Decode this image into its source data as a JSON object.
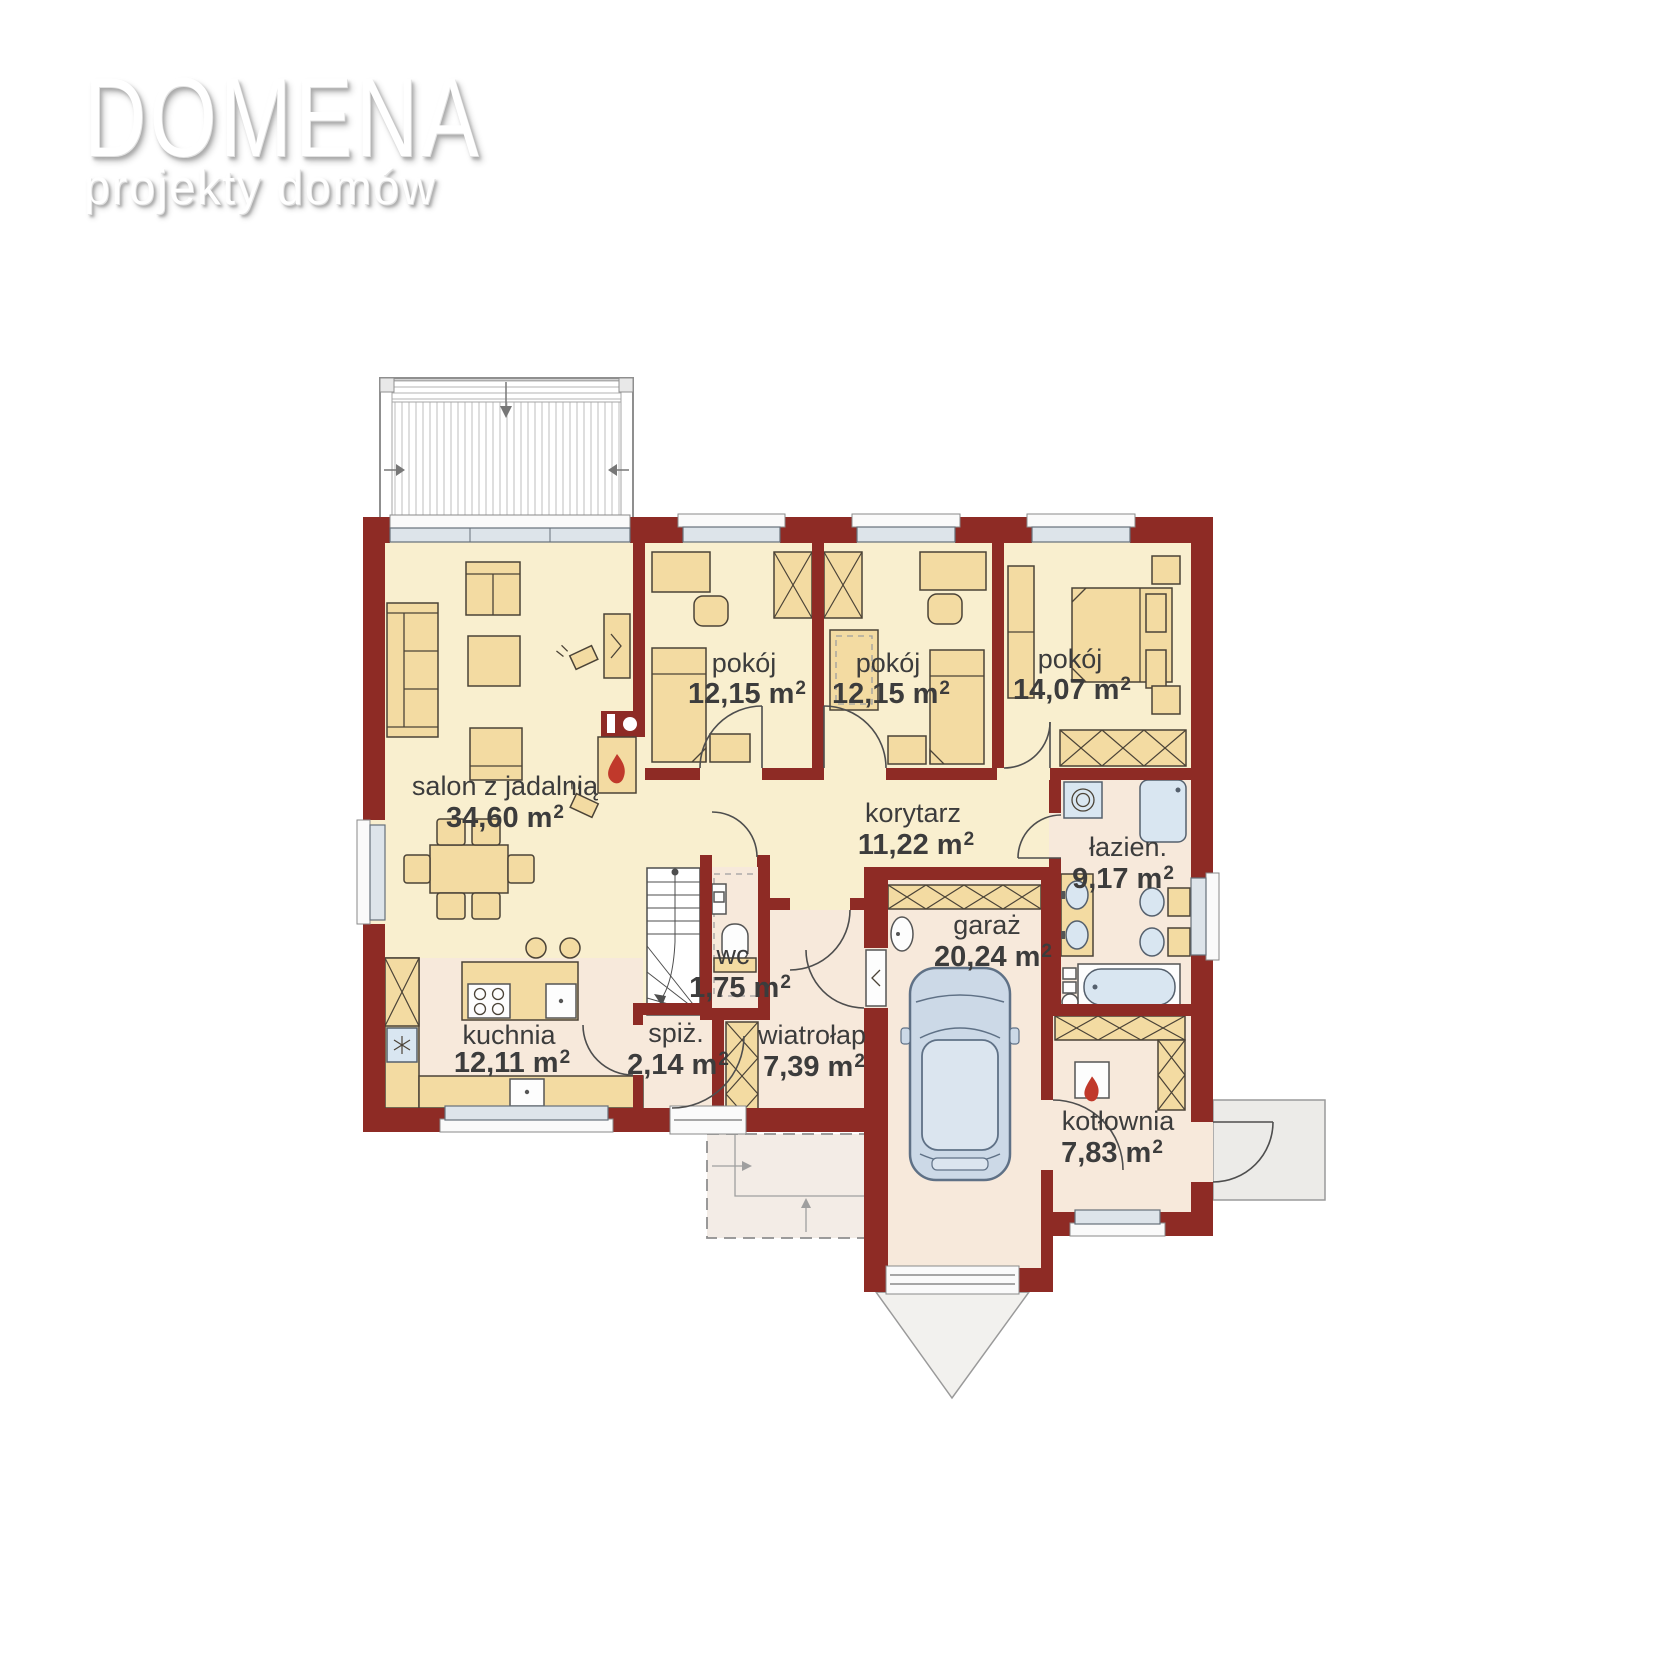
{
  "logo": {
    "title": "DOMENA",
    "subtitle": "projekty domów"
  },
  "units": {
    "m": "m",
    "sup": "2"
  },
  "rooms": {
    "salon": {
      "name": "salon z jadalnią",
      "area": "34,60"
    },
    "pokoj1": {
      "name": "pokój",
      "area": "12,15"
    },
    "pokoj2": {
      "name": "pokój",
      "area": "12,15"
    },
    "pokoj3": {
      "name": "pokój",
      "area": "14,07"
    },
    "korytarz": {
      "name": "korytarz",
      "area": "11,22"
    },
    "lazienka": {
      "name": "łazien.",
      "area": "9,17"
    },
    "wc": {
      "name": "wc",
      "area": "1,75"
    },
    "spizarnia": {
      "name": "spiż.",
      "area": "2,14"
    },
    "kuchnia": {
      "name": "kuchnia",
      "area": "12,11"
    },
    "wiatrolap": {
      "name": "wiatrołap",
      "area": "7,39"
    },
    "garaz": {
      "name": "garaż",
      "area": "20,24"
    },
    "kotlownia": {
      "name": "kotłownia",
      "area": "7,83"
    }
  },
  "colors": {
    "wall": "#8e2b25",
    "floor_main": "#f9efcf",
    "floor_service": "#f7e9db",
    "furniture": "#f3dba2",
    "fixture_blue": "#d9e6f1",
    "flame_accent": "#c0392b",
    "window_glass": "#dde4ea"
  }
}
